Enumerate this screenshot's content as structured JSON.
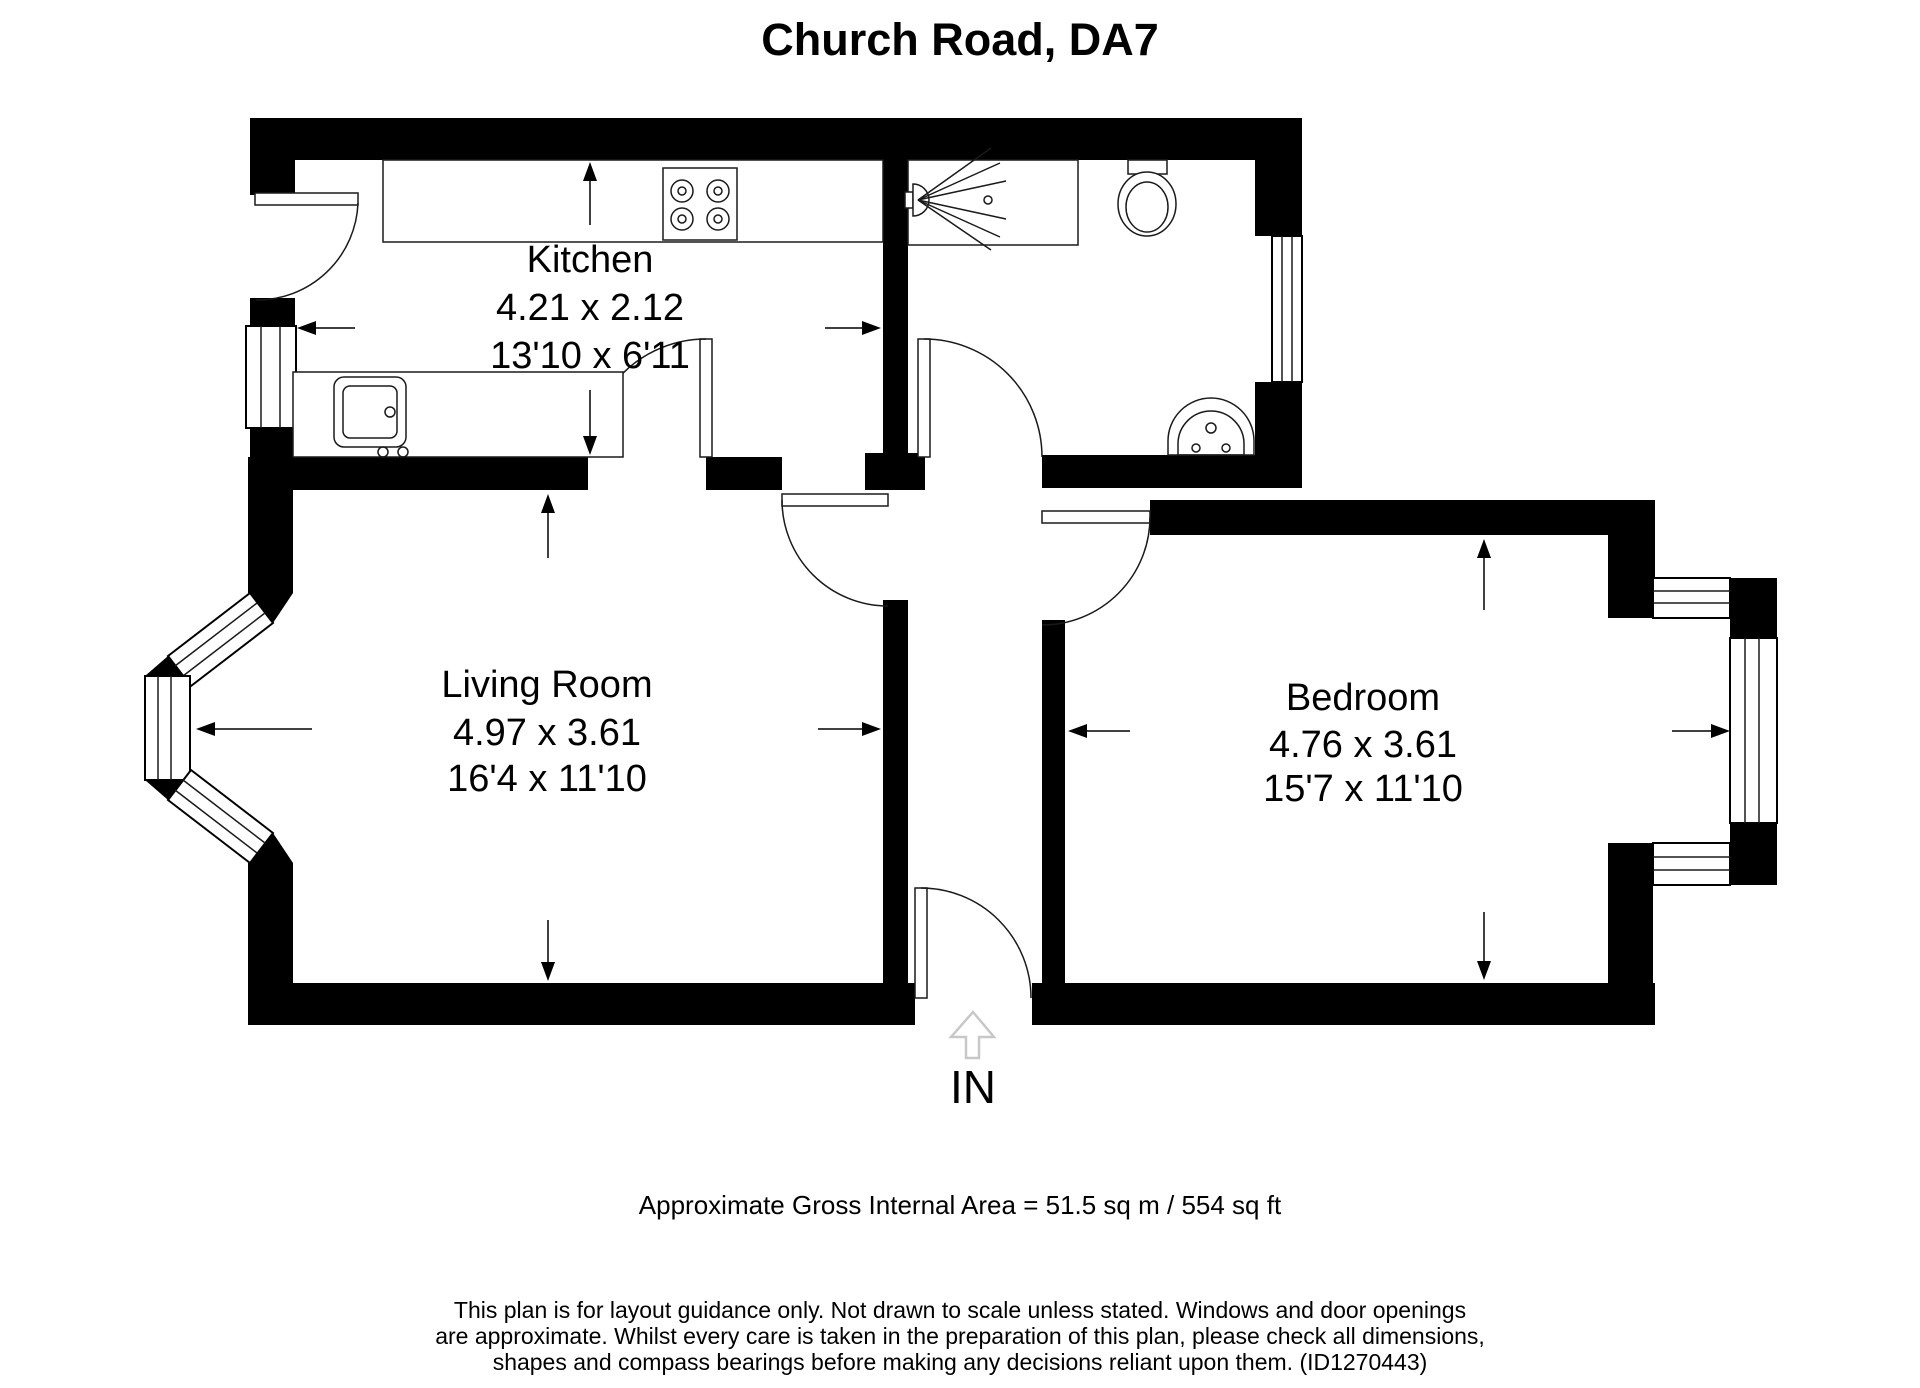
{
  "title": "Church Road, DA7",
  "floorplan": {
    "rooms": [
      {
        "name": "Kitchen",
        "metric": "4.21 x 2.12",
        "imperial": "13'10 x 6'11"
      },
      {
        "name": "Living Room",
        "metric": "4.97 x 3.61",
        "imperial": "16'4 x 11'10"
      },
      {
        "name": "Bedroom",
        "metric": "4.76 x 3.61",
        "imperial": "15'7 x 11'10"
      }
    ],
    "entrance_label": "IN"
  },
  "footer": {
    "area_note": "Approximate Gross Internal Area = 51.5 sq m / 554 sq ft",
    "disclaimer_lines": [
      "This plan is for layout guidance only. Not drawn to scale unless stated. Windows and door openings",
      "are approximate. Whilst every care is taken in the preparation of this plan, please check all dimensions,",
      "shapes and compass bearings before making any decisions reliant upon them. (ID1270443)"
    ]
  },
  "colors": {
    "wall": "#000000",
    "background": "#ffffff",
    "fixture_line": "#1a1a1a",
    "entry_arrow": "#c8c8c8",
    "text": "#000000"
  }
}
